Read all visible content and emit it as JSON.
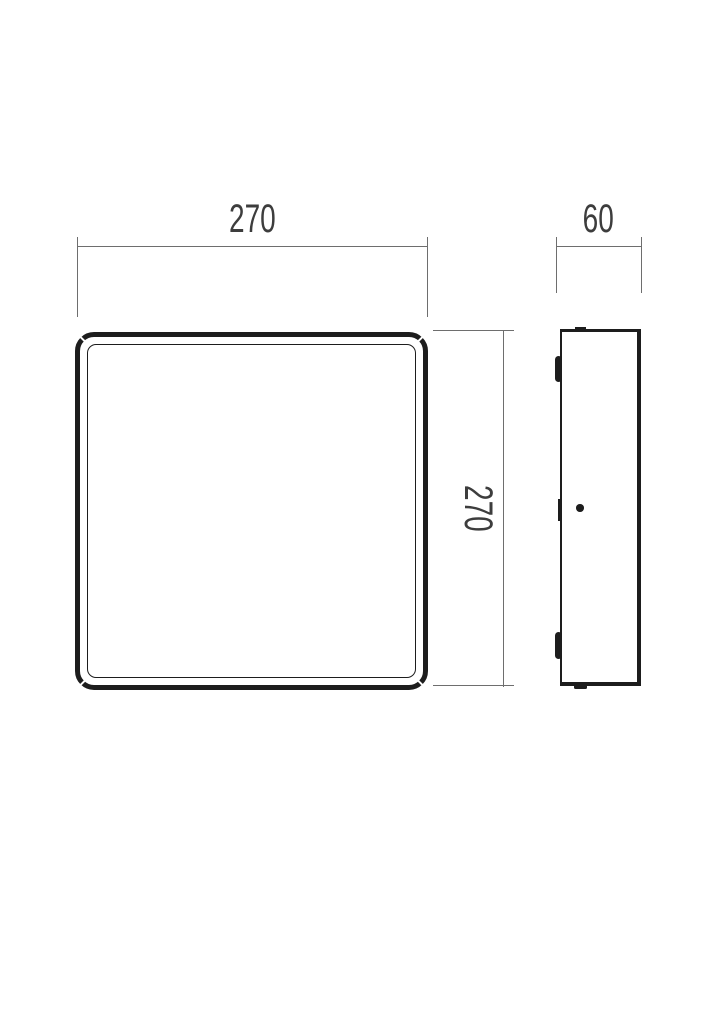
{
  "drawing": {
    "dimensions": {
      "front_width": "270",
      "front_height": "270",
      "side_depth": "60"
    },
    "colors": {
      "object_line": "#1d1d1d",
      "dimension_line": "#6e6e6e",
      "dimension_text": "#3d3d3d",
      "background": "#ffffff"
    }
  }
}
